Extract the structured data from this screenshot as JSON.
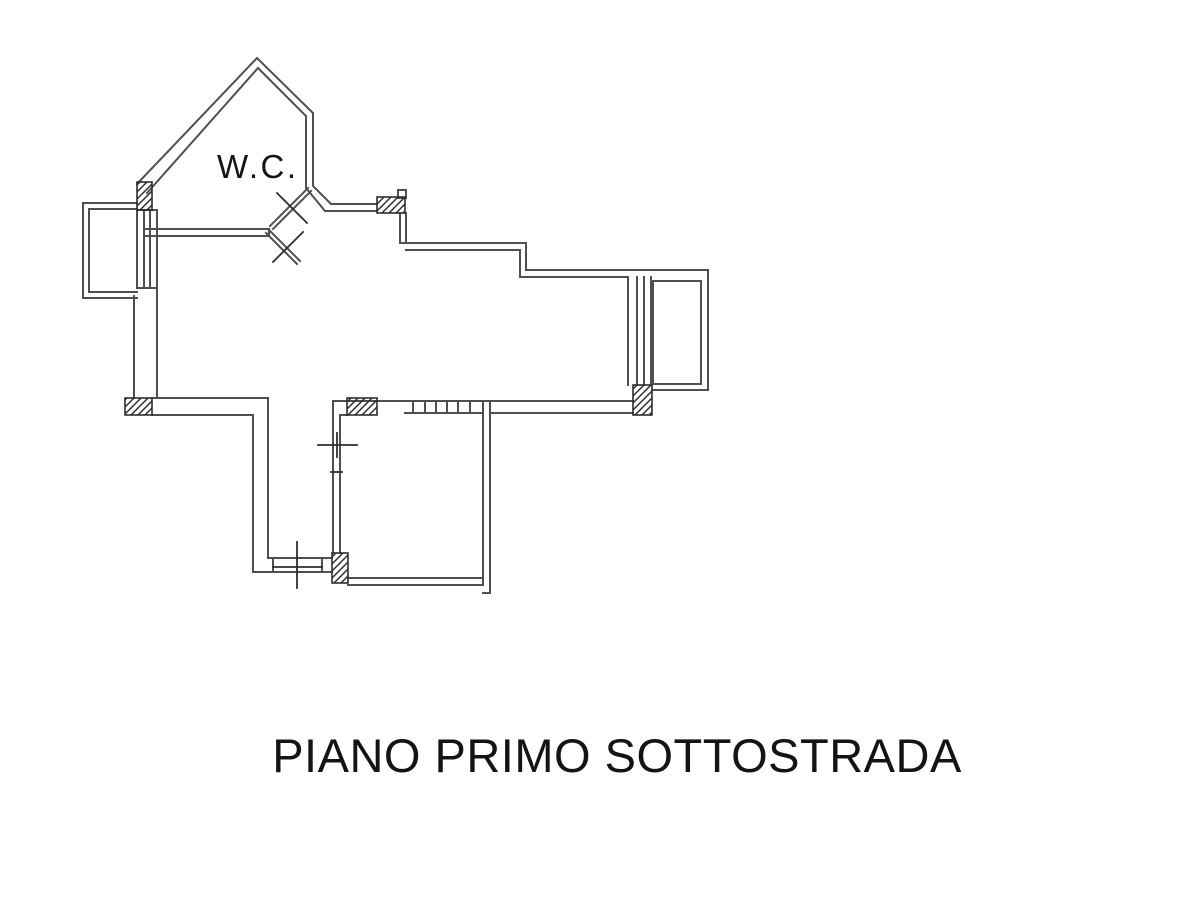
{
  "canvas": {
    "width": 1200,
    "height": 900,
    "background": "#ffffff"
  },
  "plan": {
    "wc_label": "W.C.",
    "title": "PIANO PRIMO SOTTOSTRADA",
    "colors": {
      "wall": "#4f4f4f",
      "detail": "#2e2e2e",
      "text": "#141414"
    }
  }
}
